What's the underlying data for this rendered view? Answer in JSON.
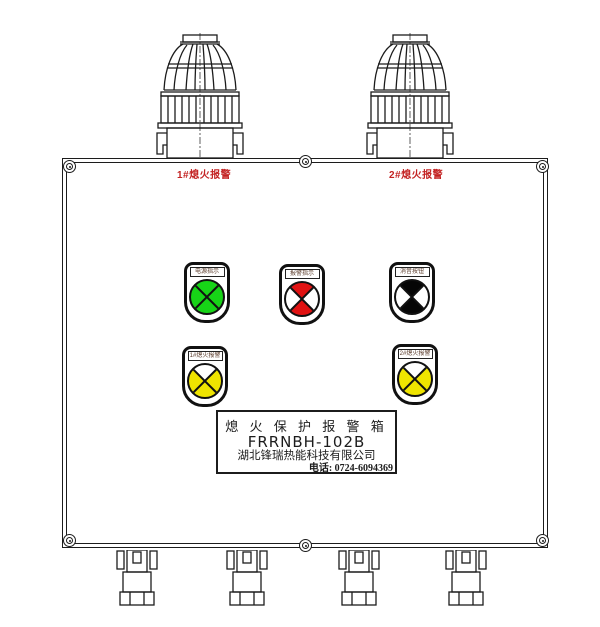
{
  "beacons": [
    {
      "label": "1#熄火报警"
    },
    {
      "label": "2#熄火报警"
    }
  ],
  "indicators": [
    {
      "label": "电源指示",
      "color": "#17d417",
      "row": 1
    },
    {
      "label": "报警指示",
      "color": "#e01212",
      "row": 1
    },
    {
      "label": "消音按钮",
      "color": "#060606",
      "row": 1
    },
    {
      "label": "1#熄火报警",
      "color": "#efe400",
      "row": 2
    },
    {
      "label": "2#熄火报警",
      "color": "#efe400",
      "row": 2
    }
  ],
  "nameplate": {
    "product_name": "熄 火 保 护 报 警 箱",
    "model": "FRRNBH-102B",
    "company": "湖北锋瑞热能科技有限公司",
    "phone": "电话: 0724-6094369"
  },
  "colors": {
    "line": "#1c1c1c",
    "channel_label_red": "#c32222",
    "background": "#ffffff"
  }
}
